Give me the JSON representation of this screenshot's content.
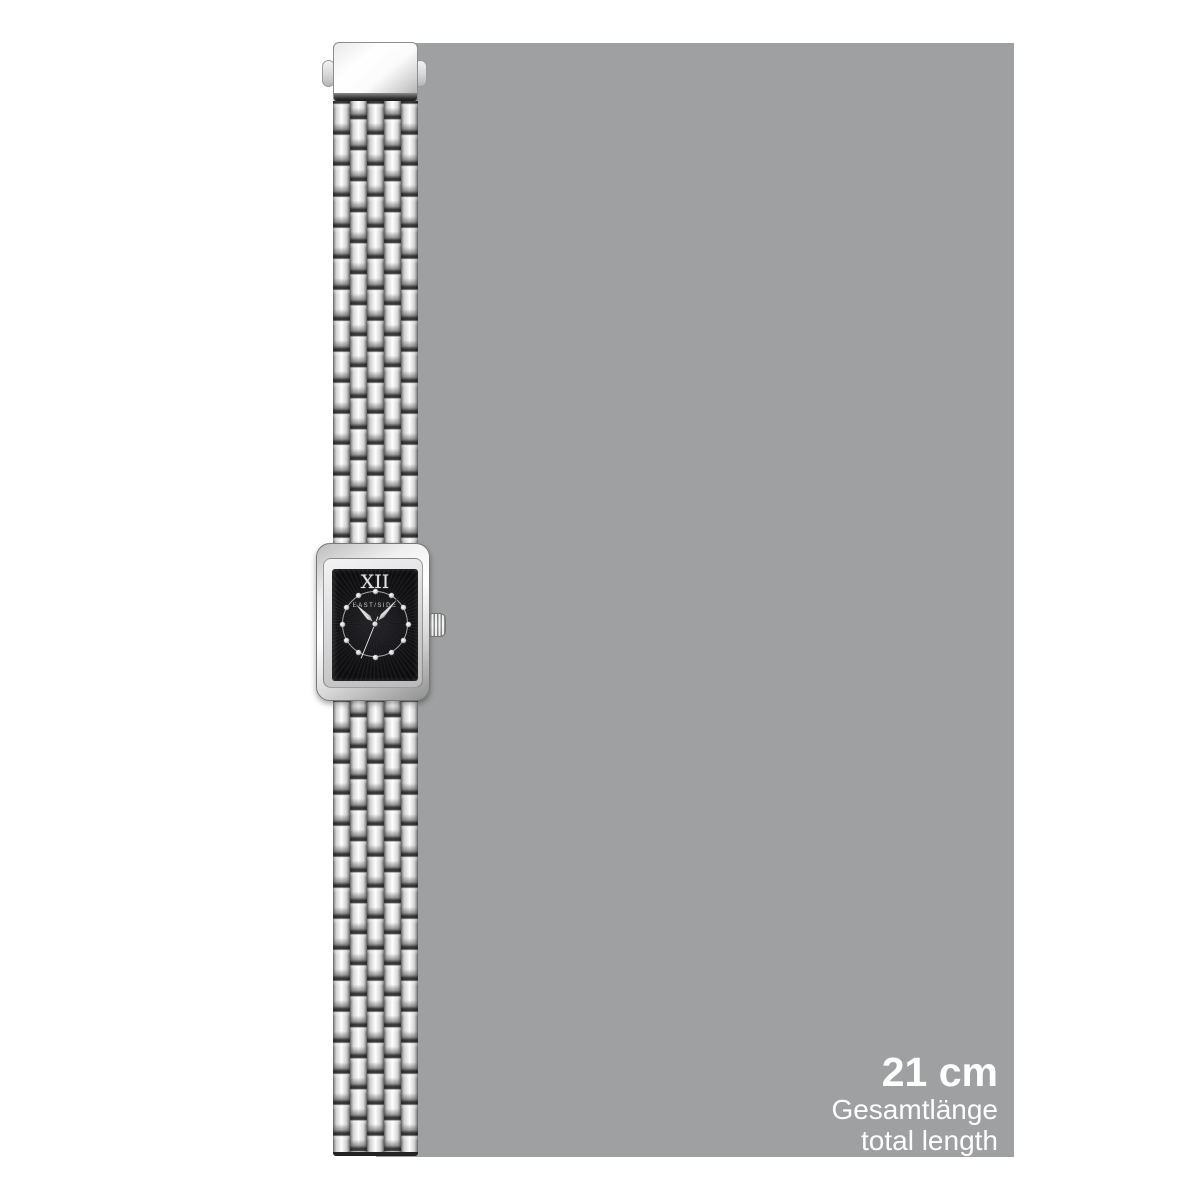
{
  "watch": {
    "brand": "EAST/SIDE",
    "dial_numeral_top": "XII",
    "dial_numeral_bottom": "VI"
  },
  "measurement": {
    "value": "21 cm",
    "label_de": "Gesamtlänge",
    "label_en": "total length"
  },
  "colors": {
    "page_background": "#ffffff",
    "measure_panel_gray": "#9ea0a1",
    "measure_text": "#ffffff",
    "dial_black": "#121215",
    "metal_silver": "#d6d6d6"
  }
}
